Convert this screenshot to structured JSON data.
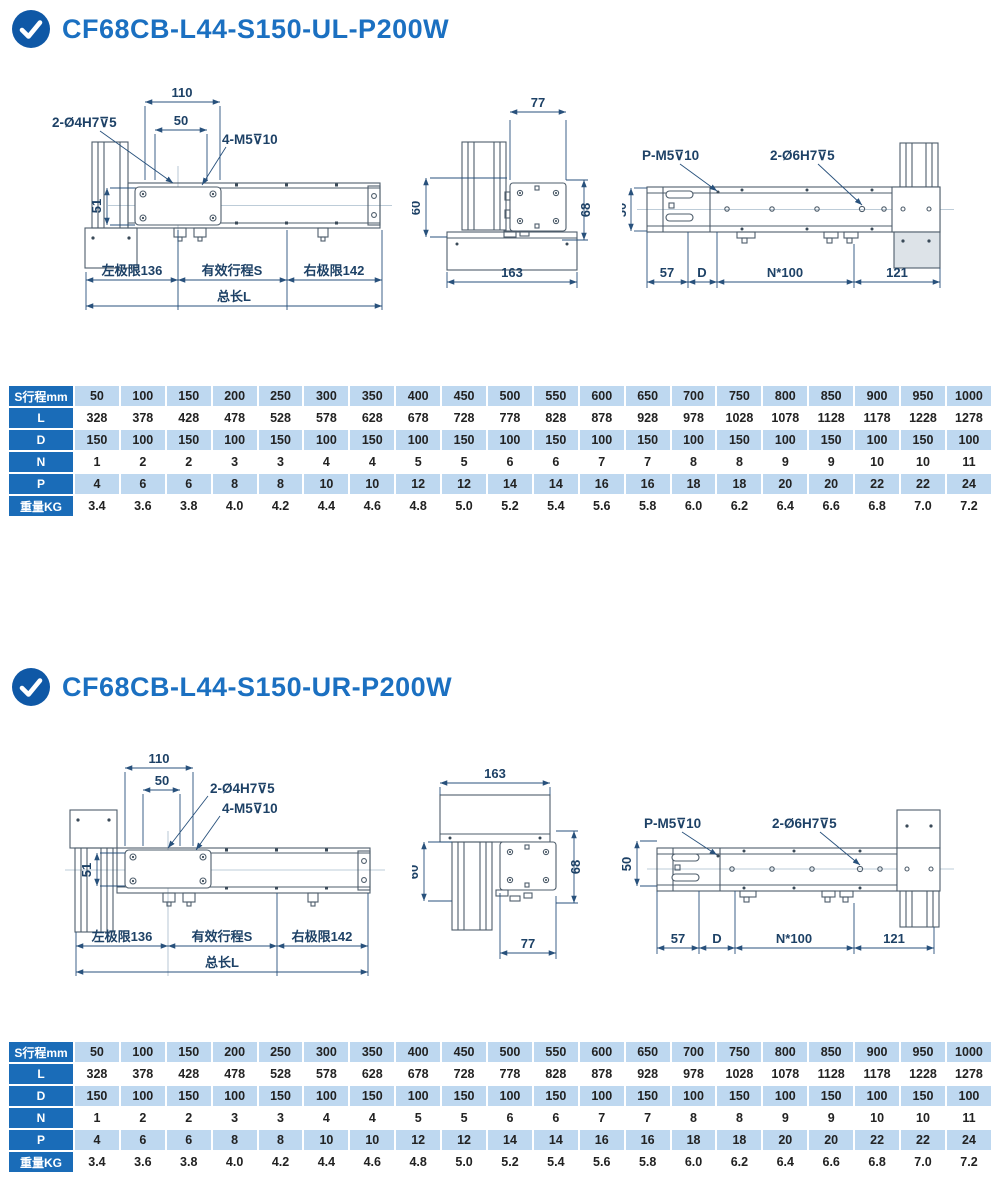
{
  "colors": {
    "accent_blue": "#1b70c1",
    "icon_blue": "#0f58a6",
    "table_header_bg": "#1a6cb8",
    "table_stripe": "#bed8f0"
  },
  "sections": [
    {
      "id": "UL",
      "title": "CF68CB-L44-S150-UL-P200W",
      "front": {
        "dim_110": "110",
        "dim_50": "50",
        "label_dowel": "2-Ø4H7⊽5",
        "label_screw": "4-M5⊽10",
        "dim_51": "51",
        "left_limit": "左极限136",
        "stroke": "有效行程S",
        "right_limit": "右极限142",
        "total_length": "总长L"
      },
      "side": {
        "dim_width": "77",
        "dim_60": "60",
        "dim_68": "68",
        "dim_base": "163"
      },
      "top": {
        "label_screw": "P-M5⊽10",
        "label_dowel": "2-Ø6H7⊽5",
        "dim_50": "50",
        "dim_57": "57",
        "dim_d": "D",
        "dim_n": "N*100",
        "dim_121": "121"
      },
      "table": {
        "rows": [
          {
            "label": "S行程mm",
            "values": [
              "50",
              "100",
              "150",
              "200",
              "250",
              "300",
              "350",
              "400",
              "450",
              "500",
              "550",
              "600",
              "650",
              "700",
              "750",
              "800",
              "850",
              "900",
              "950",
              "1000"
            ]
          },
          {
            "label": "L",
            "values": [
              "328",
              "378",
              "428",
              "478",
              "528",
              "578",
              "628",
              "678",
              "728",
              "778",
              "828",
              "878",
              "928",
              "978",
              "1028",
              "1078",
              "1128",
              "1178",
              "1228",
              "1278"
            ]
          },
          {
            "label": "D",
            "values": [
              "150",
              "100",
              "150",
              "100",
              "150",
              "100",
              "150",
              "100",
              "150",
              "100",
              "150",
              "100",
              "150",
              "100",
              "150",
              "100",
              "150",
              "100",
              "150",
              "100"
            ]
          },
          {
            "label": "N",
            "values": [
              "1",
              "2",
              "2",
              "3",
              "3",
              "4",
              "4",
              "5",
              "5",
              "6",
              "6",
              "7",
              "7",
              "8",
              "8",
              "9",
              "9",
              "10",
              "10",
              "11"
            ]
          },
          {
            "label": "P",
            "values": [
              "4",
              "6",
              "6",
              "8",
              "8",
              "10",
              "10",
              "12",
              "12",
              "14",
              "14",
              "16",
              "16",
              "18",
              "18",
              "20",
              "20",
              "22",
              "22",
              "24"
            ]
          },
          {
            "label": "重量KG",
            "values": [
              "3.4",
              "3.6",
              "3.8",
              "4.0",
              "4.2",
              "4.4",
              "4.6",
              "4.8",
              "5.0",
              "5.2",
              "5.4",
              "5.6",
              "5.8",
              "6.0",
              "6.2",
              "6.4",
              "6.6",
              "6.8",
              "7.0",
              "7.2"
            ]
          }
        ]
      }
    },
    {
      "id": "UR",
      "title": "CF68CB-L44-S150-UR-P200W",
      "front": {
        "dim_110": "110",
        "dim_50": "50",
        "label_dowel": "2-Ø4H7⊽5",
        "label_screw": "4-M5⊽10",
        "dim_51": "51",
        "left_limit": "左极限136",
        "stroke": "有效行程S",
        "right_limit": "右极限142",
        "total_length": "总长L"
      },
      "side": {
        "dim_base": "163",
        "dim_60": "60",
        "dim_68": "68",
        "dim_width": "77"
      },
      "top": {
        "label_screw": "P-M5⊽10",
        "label_dowel": "2-Ø6H7⊽5",
        "dim_50": "50",
        "dim_57": "57",
        "dim_d": "D",
        "dim_n": "N*100",
        "dim_121": "121"
      },
      "table": {
        "rows": [
          {
            "label": "S行程mm",
            "values": [
              "50",
              "100",
              "150",
              "200",
              "250",
              "300",
              "350",
              "400",
              "450",
              "500",
              "550",
              "600",
              "650",
              "700",
              "750",
              "800",
              "850",
              "900",
              "950",
              "1000"
            ]
          },
          {
            "label": "L",
            "values": [
              "328",
              "378",
              "428",
              "478",
              "528",
              "578",
              "628",
              "678",
              "728",
              "778",
              "828",
              "878",
              "928",
              "978",
              "1028",
              "1078",
              "1128",
              "1178",
              "1228",
              "1278"
            ]
          },
          {
            "label": "D",
            "values": [
              "150",
              "100",
              "150",
              "100",
              "150",
              "100",
              "150",
              "100",
              "150",
              "100",
              "150",
              "100",
              "150",
              "100",
              "150",
              "100",
              "150",
              "100",
              "150",
              "100"
            ]
          },
          {
            "label": "N",
            "values": [
              "1",
              "2",
              "2",
              "3",
              "3",
              "4",
              "4",
              "5",
              "5",
              "6",
              "6",
              "7",
              "7",
              "8",
              "8",
              "9",
              "9",
              "10",
              "10",
              "11"
            ]
          },
          {
            "label": "P",
            "values": [
              "4",
              "6",
              "6",
              "8",
              "8",
              "10",
              "10",
              "12",
              "12",
              "14",
              "14",
              "16",
              "16",
              "18",
              "18",
              "20",
              "20",
              "22",
              "22",
              "24"
            ]
          },
          {
            "label": "重量KG",
            "values": [
              "3.4",
              "3.6",
              "3.8",
              "4.0",
              "4.2",
              "4.4",
              "4.6",
              "4.8",
              "5.0",
              "5.2",
              "5.4",
              "5.6",
              "5.8",
              "6.0",
              "6.2",
              "6.4",
              "6.6",
              "6.8",
              "7.0",
              "7.2"
            ]
          }
        ]
      }
    }
  ]
}
